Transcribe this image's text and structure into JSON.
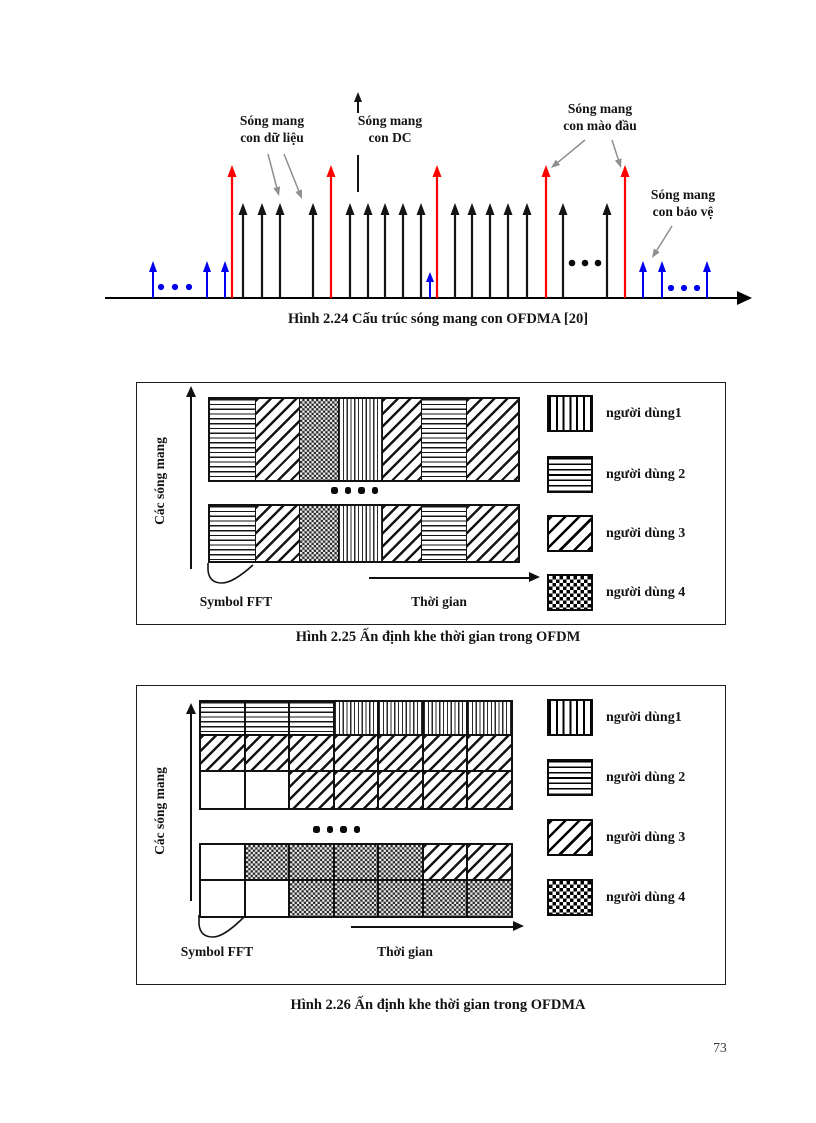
{
  "page": {
    "number": "73"
  },
  "fig224": {
    "caption": "Hình 2.24 Cấu trúc sóng mang con OFDMA [20]",
    "label_data": "Sóng mang\ncon dữ liệu",
    "label_dc": "Sóng mang\ncon DC",
    "label_preamble": "Sóng mang\ncon mào đầu",
    "label_guard": "Sóng mang\ncon bảo vệ",
    "colors": {
      "pilot_red": "#ff0000",
      "guard_blue": "#0000ee",
      "data_black": "#141414",
      "pointer_gray": "#8f8f8f"
    },
    "subcarriers": {
      "red_x": [
        232,
        331,
        437,
        546,
        625
      ],
      "black_x": [
        243,
        262,
        280,
        313,
        350,
        368,
        385,
        403,
        421,
        455,
        472,
        490,
        508,
        527,
        563,
        607
      ],
      "blue_x": [
        153,
        207,
        225,
        643,
        662,
        707
      ],
      "blue_short_x": [
        430
      ],
      "black_dots": [
        [
          572,
          263
        ],
        [
          585,
          263
        ],
        [
          598,
          263
        ]
      ],
      "blue_dots": [
        [
          161,
          287
        ],
        [
          175,
          287
        ],
        [
          189,
          287
        ],
        [
          671,
          288
        ],
        [
          684,
          288
        ],
        [
          697,
          288
        ]
      ]
    }
  },
  "fig225": {
    "caption": "Hình 2.25 Ấn định khe thời gian trong OFDM",
    "ylabel": "Các sóng mang",
    "fft_label": "Symbol FFT",
    "xlabel": "Thời gian",
    "bar_patterns": [
      "h",
      "d",
      "c",
      "v",
      "d",
      "h",
      "d"
    ],
    "legend": [
      {
        "pattern": "v",
        "label": "người dùng1"
      },
      {
        "pattern": "h",
        "label": "người dùng 2"
      },
      {
        "pattern": "d",
        "label": "người dùng 3"
      },
      {
        "pattern": "c",
        "label": "người dùng 4"
      }
    ]
  },
  "fig226": {
    "caption": "Hình 2.26 Ấn định khe thời gian trong OFDMA",
    "ylabel": "Các sóng mang",
    "fft_label": "Symbol FFT",
    "xlabel": "Thời gian",
    "grid_top": [
      [
        "h",
        "h",
        "h",
        "v",
        "v",
        "v",
        "v"
      ],
      [
        "d",
        "d",
        "d",
        "d",
        "d",
        "d",
        "d"
      ],
      [
        "w",
        "w",
        "d",
        "d",
        "d",
        "d",
        "d"
      ]
    ],
    "grid_bottom": [
      [
        "w",
        "c",
        "c",
        "c",
        "c",
        "d",
        "d"
      ],
      [
        "w",
        "w",
        "c",
        "c",
        "c",
        "c",
        "c"
      ]
    ],
    "legend": [
      {
        "pattern": "v",
        "label": "người dùng1"
      },
      {
        "pattern": "h",
        "label": "người dùng 2"
      },
      {
        "pattern": "d",
        "label": "người dùng 3"
      },
      {
        "pattern": "c",
        "label": "người dùng 4"
      }
    ]
  }
}
